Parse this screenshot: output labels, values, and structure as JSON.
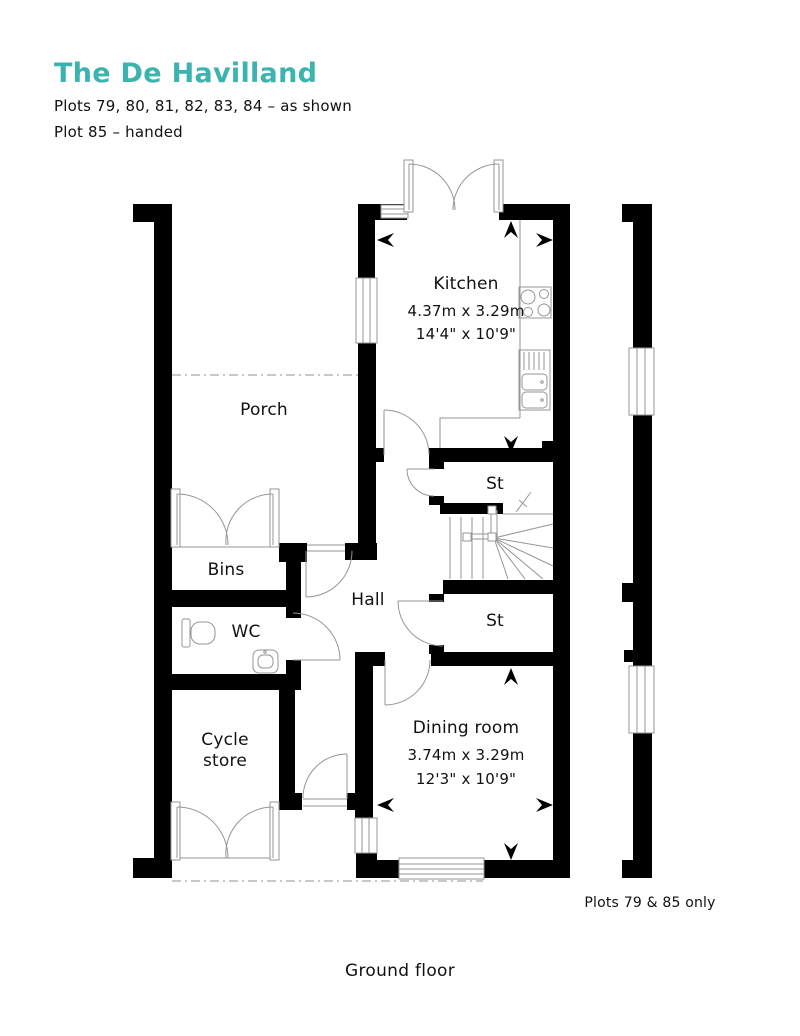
{
  "header": {
    "title": "The De Havilland",
    "subtitle1": "Plots 79, 80, 81, 82, 83, 84 – as shown",
    "subtitle2": "Plot 85 – handed"
  },
  "rooms": {
    "kitchen": {
      "name": "Kitchen",
      "metric": "4.37m x 3.29m",
      "imperial": "14'4\" x 10'9\""
    },
    "dining": {
      "name": "Dining room",
      "metric": "3.74m x 3.29m",
      "imperial": "12'3\" x 10'9\""
    },
    "porch": {
      "name": "Porch"
    },
    "bins": {
      "name": "Bins"
    },
    "wc": {
      "name": "WC"
    },
    "hall": {
      "name": "Hall"
    },
    "store1": {
      "name": "St"
    },
    "store2": {
      "name": "St"
    },
    "cycle_store": {
      "name": "Cycle store"
    }
  },
  "annotations": {
    "plots_note": "Plots 79 & 85 only",
    "floor_label": "Ground floor"
  },
  "icons": {
    "dimension_arrows": [
      "left",
      "right",
      "up",
      "down"
    ]
  },
  "colors": {
    "accent_teal": "#3bb3af",
    "wall_black": "#000000",
    "fixture_line": "#969696",
    "dashed_line": "#b5b5b5"
  }
}
